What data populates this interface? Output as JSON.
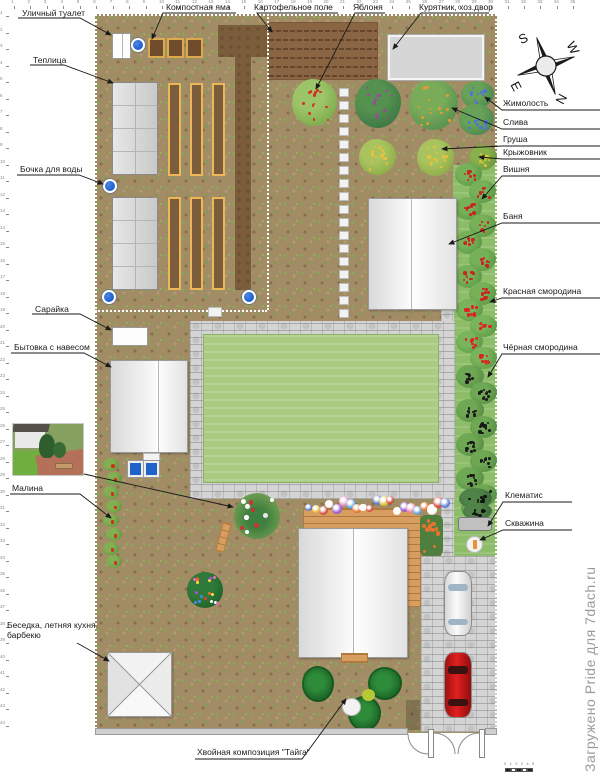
{
  "watermark": "Загружено Pride для 7dach.ru",
  "compass": {
    "s": "S",
    "w": "W",
    "n": "N",
    "e": "E"
  },
  "rulers": {
    "top": {
      "start": 1,
      "count": 35
    },
    "left": {
      "start": 1,
      "count": 44
    }
  },
  "scalebar": {
    "ticks": [
      "0",
      "1",
      "2",
      "3",
      "4",
      "5"
    ]
  },
  "annotations": [
    {
      "id": "compost-pit",
      "text": "Компостная яма",
      "x": 166,
      "y": 3,
      "path": "M 236,13 L 163,13 L 152,39"
    },
    {
      "id": "potato-field",
      "text": "Картофельное поле",
      "x": 254,
      "y": 3,
      "path": "M 338,13 L 257,13 L 272,32"
    },
    {
      "id": "apple-tree",
      "text": "Яблоня",
      "x": 353,
      "y": 3,
      "path": "M 385,13 L 355,13 L 316,89"
    },
    {
      "id": "chicken-coop",
      "text": "Курятник, хоз.двор",
      "x": 419,
      "y": 3,
      "path": "M 489,13 L 421,13 L 393,49"
    },
    {
      "id": "outdoor-toilet",
      "text": "Уличный туалет",
      "x": 22,
      "y": 9,
      "path": "M 18,18 L 80,18 L 111,35"
    },
    {
      "id": "greenhouse",
      "text": "Теплица",
      "x": 33,
      "y": 56,
      "path": "M 30,65 L 64,65 L 113,83"
    },
    {
      "id": "water-barrel",
      "text": "Бочка для воды",
      "x": 20,
      "y": 165,
      "path": "M 17,175 L 79,175 L 103,184"
    },
    {
      "id": "shed",
      "text": "Сарайка",
      "x": 35,
      "y": 305,
      "path": "M 32,314 L 80,314 L 111,330"
    },
    {
      "id": "cabin",
      "text": "Бытовка с навесом",
      "x": 14,
      "y": 343,
      "path": "M 11,353 L 84,353 L 111,367"
    },
    {
      "id": "raspberry",
      "text": "Малина",
      "x": 12,
      "y": 484,
      "path": "M 10,494 L 80,494 L 111,518"
    },
    {
      "id": "gazebo",
      "text": "Беседка, летняя кухня, барбекю",
      "x": 7,
      "y": 621,
      "wrap": true,
      "w": 92,
      "path": "M 77,643 L 109,661"
    },
    {
      "id": "honeysuckle",
      "text": "Жимолость",
      "x": 503,
      "y": 99,
      "path": "M 600,110 L 502,110 L 485,97"
    },
    {
      "id": "plum",
      "text": "Слива",
      "x": 503,
      "y": 118,
      "path": "M 600,129 L 502,129 L 452,108"
    },
    {
      "id": "pear",
      "text": "Груша",
      "x": 503,
      "y": 135,
      "path": "M 600,146 L 502,146 L 442,149"
    },
    {
      "id": "gooseberry",
      "text": "Крыжовник",
      "x": 503,
      "y": 148,
      "path": "M 600,159 L 502,159 L 479,157"
    },
    {
      "id": "cherry",
      "text": "Вишня",
      "x": 503,
      "y": 165,
      "path": "M 600,176 L 502,176 L 482,199"
    },
    {
      "id": "banya",
      "text": "Баня",
      "x": 503,
      "y": 212,
      "path": "M 600,223 L 502,223 L 449,244"
    },
    {
      "id": "red-currant",
      "text": "Красная смородина",
      "x": 503,
      "y": 287,
      "path": "M 600,298 L 502,298 L 490,302"
    },
    {
      "id": "black-currant",
      "text": "Чёрная смородина",
      "x": 503,
      "y": 343,
      "path": "M 600,354 L 502,354 L 488,377"
    },
    {
      "id": "clematis",
      "text": "Клематис",
      "x": 505,
      "y": 491,
      "path": "M 572,502 L 503,502 L 488,526"
    },
    {
      "id": "borehole",
      "text": "Скважина",
      "x": 505,
      "y": 519,
      "path": "M 572,530 L 503,530 L 480,540"
    },
    {
      "id": "conifer-composition",
      "text": "Хвойная композиция \"Тайга\"",
      "x": 197,
      "y": 748,
      "path": "M 195,759 L 302,759 L 346,699"
    },
    {
      "id": "photo-leader",
      "text": "",
      "x": 0,
      "y": 0,
      "path": "M 84,474 L 233,507"
    }
  ],
  "plan": {
    "zones": [
      {
        "name": "plot-soil",
        "cls": "soil",
        "x": 95,
        "y": 14,
        "w": 402,
        "h": 719
      },
      {
        "name": "potato-field",
        "cls": "potato",
        "x": 268,
        "y": 22,
        "w": 110,
        "h": 58
      },
      {
        "name": "green-band",
        "cls": "band",
        "x": 453,
        "y": 165,
        "w": 44,
        "h": 393
      },
      {
        "name": "cobble-strip",
        "cls": "cobble",
        "x": 441,
        "y": 310,
        "w": 13,
        "h": 250
      },
      {
        "name": "driveway",
        "cls": "cobble",
        "x": 421,
        "y": 556,
        "w": 76,
        "h": 176
      },
      {
        "name": "path-ring",
        "cls": "cobble",
        "x": 190,
        "y": 321,
        "w": 265,
        "h": 178
      },
      {
        "name": "lawn",
        "cls": "lawn",
        "x": 203,
        "y": 334,
        "w": 236,
        "h": 149
      },
      {
        "name": "tilled-band",
        "cls": "tilled",
        "x": 218,
        "y": 25,
        "w": 49,
        "h": 32
      },
      {
        "name": "tilled-strip",
        "cls": "tilled",
        "x": 235,
        "y": 25,
        "w": 16,
        "h": 265
      }
    ],
    "beds": [
      [
        168,
        83
      ],
      [
        190,
        83
      ],
      [
        212,
        83
      ],
      [
        168,
        197
      ],
      [
        190,
        197
      ],
      [
        212,
        197
      ]
    ],
    "bed_size": {
      "w": 13,
      "h": 93
    },
    "compost_bins": [
      [
        148,
        38
      ],
      [
        167,
        38
      ],
      [
        186,
        38
      ]
    ],
    "barrels": [
      [
        138,
        45
      ],
      [
        110,
        186
      ],
      [
        109,
        297
      ],
      [
        249,
        297
      ]
    ],
    "stones_column": {
      "x": 339,
      "y0": 88,
      "y1": 318,
      "step": 13,
      "w": 10,
      "h": 9
    },
    "stone_single": {
      "x": 208,
      "y": 307,
      "w": 14,
      "h": 10
    },
    "fences": [
      {
        "name": "fence-top",
        "type": "h",
        "x": 95,
        "y": 14,
        "len": 402
      },
      {
        "name": "fence-left",
        "type": "v",
        "x": 95,
        "y": 14,
        "len": 719
      },
      {
        "name": "fence-right",
        "type": "v",
        "x": 495,
        "y": 14,
        "len": 719
      },
      {
        "name": "fence-inner-v",
        "type": "v",
        "x": 267,
        "y": 14,
        "len": 296
      },
      {
        "name": "fence-inner-h",
        "type": "h",
        "x": 95,
        "y": 310,
        "len": 172
      }
    ],
    "bushes": [
      {
        "name": "apple-tree",
        "x": 292,
        "y": 79,
        "w": 45,
        "h": 47,
        "base": "#7fae4e",
        "light": "#9cc468",
        "dot": "#d43222",
        "n": 13
      },
      {
        "name": "berry-bush-purple",
        "x": 355,
        "y": 79,
        "w": 46,
        "h": 49,
        "base": "#3f7a46",
        "light": "#55924f",
        "dot": "#9a4a9a",
        "n": 12
      },
      {
        "name": "plum-tree",
        "x": 409,
        "y": 79,
        "w": 49,
        "h": 51,
        "base": "#5a9350",
        "light": "#79ab59",
        "dot": "#e89b2e",
        "n": 14
      },
      {
        "name": "honeysuckle-bush",
        "x": 461,
        "y": 81,
        "w": 33,
        "h": 27,
        "base": "#4f8a4f",
        "light": "#68a258",
        "dot": "#4f74d8",
        "n": 10
      },
      {
        "name": "honeysuckle-bush",
        "x": 459,
        "y": 104,
        "w": 35,
        "h": 31,
        "base": "#4f8a4f",
        "light": "#68a258",
        "dot": "#4f74d8",
        "n": 11
      },
      {
        "name": "yellow-bush",
        "x": 359,
        "y": 139,
        "w": 37,
        "h": 36,
        "base": "#8fae4a",
        "light": "#a9c45e",
        "dot": "#e8c23e",
        "n": 13
      },
      {
        "name": "pear-tree",
        "x": 417,
        "y": 139,
        "w": 37,
        "h": 37,
        "base": "#8fae4a",
        "light": "#a9c45e",
        "dot": "#e8c23e",
        "n": 13
      },
      {
        "name": "gooseberry-bush",
        "x": 469,
        "y": 145,
        "w": 28,
        "h": 25,
        "base": "#6f9a3f",
        "light": "#88b14c",
        "dot": "#d8c832",
        "n": 9
      },
      {
        "name": "cherry-bush",
        "x": 455,
        "y": 163,
        "w": 27,
        "h": 23,
        "base": "#5f9a48",
        "light": "#76b158",
        "dot": "#cc2222",
        "n": 9
      },
      {
        "name": "cherry-bush",
        "x": 469,
        "y": 180,
        "w": 27,
        "h": 23,
        "base": "#5f9a48",
        "light": "#76b158",
        "dot": "#cc2222",
        "n": 9
      },
      {
        "name": "cherry-bush",
        "x": 455,
        "y": 197,
        "w": 27,
        "h": 23,
        "base": "#5f9a48",
        "light": "#76b158",
        "dot": "#cc2222",
        "n": 9
      },
      {
        "name": "cherry-bush",
        "x": 469,
        "y": 214,
        "w": 27,
        "h": 23,
        "base": "#5f9a48",
        "light": "#76b158",
        "dot": "#cc2222",
        "n": 9
      },
      {
        "name": "cherry-bush",
        "x": 455,
        "y": 231,
        "w": 27,
        "h": 23,
        "base": "#5f9a48",
        "light": "#76b158",
        "dot": "#cc2222",
        "n": 9
      },
      {
        "name": "cherry-bush",
        "x": 469,
        "y": 248,
        "w": 27,
        "h": 23,
        "base": "#5f9a48",
        "light": "#76b158",
        "dot": "#cc2222",
        "n": 9
      },
      {
        "name": "cherry-bush",
        "x": 455,
        "y": 265,
        "w": 27,
        "h": 23,
        "base": "#5f9a48",
        "light": "#76b158",
        "dot": "#cc2222",
        "n": 9
      },
      {
        "name": "cherry-bush",
        "x": 469,
        "y": 282,
        "w": 27,
        "h": 23,
        "base": "#5f9a48",
        "light": "#76b158",
        "dot": "#cc2222",
        "n": 9
      },
      {
        "name": "red-currant-bush",
        "x": 456,
        "y": 299,
        "w": 27,
        "h": 22,
        "base": "#619c4a",
        "light": "#79b35a",
        "dot": "#dd2222",
        "n": 9
      },
      {
        "name": "red-currant-bush",
        "x": 470,
        "y": 315,
        "w": 27,
        "h": 22,
        "base": "#619c4a",
        "light": "#79b35a",
        "dot": "#dd2222",
        "n": 9
      },
      {
        "name": "red-currant-bush",
        "x": 456,
        "y": 331,
        "w": 27,
        "h": 22,
        "base": "#619c4a",
        "light": "#79b35a",
        "dot": "#dd2222",
        "n": 9
      },
      {
        "name": "red-currant-bush",
        "x": 470,
        "y": 347,
        "w": 27,
        "h": 22,
        "base": "#619c4a",
        "light": "#79b35a",
        "dot": "#dd2222",
        "n": 9
      },
      {
        "name": "black-currant-bush",
        "x": 456,
        "y": 365,
        "w": 28,
        "h": 23,
        "base": "#5a9246",
        "light": "#6fa854",
        "dot": "#1a1a1a",
        "n": 10
      },
      {
        "name": "black-currant-bush",
        "x": 470,
        "y": 382,
        "w": 27,
        "h": 22,
        "base": "#5a9246",
        "light": "#6fa854",
        "dot": "#1a1a1a",
        "n": 10
      },
      {
        "name": "black-currant-bush",
        "x": 456,
        "y": 399,
        "w": 28,
        "h": 23,
        "base": "#5a9246",
        "light": "#6fa854",
        "dot": "#1a1a1a",
        "n": 10
      },
      {
        "name": "black-currant-bush",
        "x": 470,
        "y": 416,
        "w": 27,
        "h": 22,
        "base": "#5a9246",
        "light": "#6fa854",
        "dot": "#1a1a1a",
        "n": 10
      },
      {
        "name": "black-currant-bush",
        "x": 456,
        "y": 433,
        "w": 28,
        "h": 23,
        "base": "#5a9246",
        "light": "#6fa854",
        "dot": "#1a1a1a",
        "n": 10
      },
      {
        "name": "black-currant-bush",
        "x": 470,
        "y": 450,
        "w": 27,
        "h": 22,
        "base": "#5a9246",
        "light": "#6fa854",
        "dot": "#1a1a1a",
        "n": 10
      },
      {
        "name": "black-currant-bush",
        "x": 456,
        "y": 467,
        "w": 28,
        "h": 23,
        "base": "#5a9246",
        "light": "#6fa854",
        "dot": "#1a1a1a",
        "n": 10
      },
      {
        "name": "black-currant-bush",
        "x": 470,
        "y": 484,
        "w": 27,
        "h": 22,
        "base": "#5a9246",
        "light": "#6fa854",
        "dot": "#1a1a1a",
        "n": 10
      },
      {
        "name": "black-currant-bush",
        "x": 461,
        "y": 498,
        "w": 26,
        "h": 20,
        "base": "#5a9246",
        "light": "#6fa854",
        "dot": "#1a1a1a",
        "n": 8
      },
      {
        "name": "clematis-bush",
        "x": 459,
        "y": 488,
        "w": 33,
        "h": 21,
        "base": "#3f7040",
        "light": "#4f8348",
        "dot": "#111111",
        "n": 9
      },
      {
        "name": "clematis-bush",
        "x": 463,
        "y": 503,
        "w": 29,
        "h": 17,
        "base": "#3f7040",
        "light": "#4f8348",
        "dot": "#111111",
        "n": 7
      },
      {
        "name": "raspberry-bush",
        "x": 103,
        "y": 458,
        "w": 16,
        "h": 13,
        "base": "#6a9a42",
        "light": "#82af52",
        "dot": "#cc3322",
        "n": 5
      },
      {
        "name": "raspberry-bush",
        "x": 106,
        "y": 472,
        "w": 16,
        "h": 13,
        "base": "#6a9a42",
        "light": "#82af52",
        "dot": "#cc3322",
        "n": 5
      },
      {
        "name": "raspberry-bush",
        "x": 103,
        "y": 486,
        "w": 16,
        "h": 13,
        "base": "#6a9a42",
        "light": "#82af52",
        "dot": "#cc3322",
        "n": 5
      },
      {
        "name": "raspberry-bush",
        "x": 106,
        "y": 500,
        "w": 16,
        "h": 13,
        "base": "#6a9a42",
        "light": "#82af52",
        "dot": "#cc3322",
        "n": 5
      },
      {
        "name": "raspberry-bush",
        "x": 103,
        "y": 514,
        "w": 16,
        "h": 13,
        "base": "#6a9a42",
        "light": "#82af52",
        "dot": "#cc3322",
        "n": 5
      },
      {
        "name": "raspberry-bush",
        "x": 106,
        "y": 528,
        "w": 16,
        "h": 13,
        "base": "#6a9a42",
        "light": "#82af52",
        "dot": "#cc3322",
        "n": 5
      },
      {
        "name": "raspberry-bush",
        "x": 103,
        "y": 542,
        "w": 16,
        "h": 13,
        "base": "#6a9a42",
        "light": "#82af52",
        "dot": "#cc3322",
        "n": 5
      },
      {
        "name": "raspberry-bush",
        "x": 106,
        "y": 555,
        "w": 16,
        "h": 13,
        "base": "#6a9a42",
        "light": "#82af52",
        "dot": "#cc3322",
        "n": 5
      }
    ],
    "flower_border": {
      "x0": 305,
      "x1": 440,
      "y": 495,
      "count": 21,
      "colors": [
        "#5a7fd8",
        "#e8c23e",
        "#d84a3a",
        "#ffffff",
        "#9a5ad8",
        "#e88ab8",
        "#5a9fd8",
        "#e8732e",
        "#ffffff",
        "#d84a3a"
      ]
    },
    "orange_patch": {
      "x": 420,
      "y": 515,
      "w": 23,
      "h": 41,
      "base": "#4f7f3f",
      "dot": "#e8732e",
      "n": 12
    },
    "round_flowerbed": {
      "x": 187,
      "y": 572,
      "w": 36,
      "h": 36,
      "base": "#1e5f28",
      "colors": [
        "#e86a3a",
        "#ffd84a",
        "#4a8af0",
        "#f06ab8",
        "#ffffff",
        "#b04ae0",
        "#e83a3a"
      ],
      "n": 18
    },
    "corner_flowerbed": {
      "x": 234,
      "y": 493,
      "w": 46,
      "h": 46,
      "base": "#6b9a50"
    },
    "conifers": [
      [
        302,
        666,
        32,
        36
      ],
      [
        368,
        667,
        34,
        33
      ],
      [
        348,
        696,
        33,
        35
      ]
    ]
  }
}
